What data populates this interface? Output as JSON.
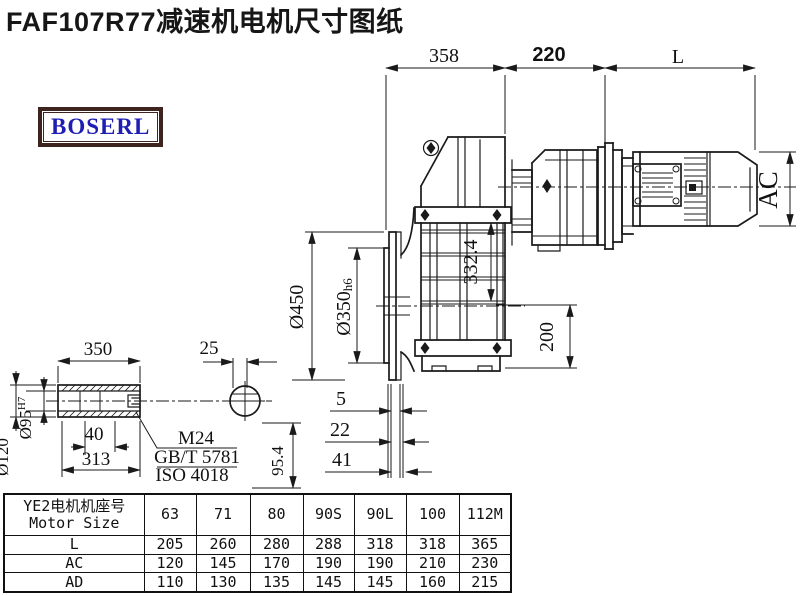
{
  "title": "FAF107R77减速机电机尺寸图纸",
  "logo": {
    "text": "BOSERL"
  },
  "drawing": {
    "dims": {
      "top_left": "358",
      "top_mid": "220",
      "top_right": "L",
      "flange_od": "Ø450",
      "spigot_main": "Ø350",
      "spigot_suffix": "h6",
      "center_height": "332.4",
      "bottom_height": "200",
      "stack_1": "5",
      "stack_2": "22",
      "stack_3": "41",
      "shaft_length": "350",
      "key_width": "25",
      "shaft_od": "Ø120",
      "bore_main": "Ø95",
      "bore_tol": "H7",
      "d40": "40",
      "d313": "313",
      "d954": "95.4",
      "thread": "M24",
      "std1": "GB/T 5781",
      "std2": "ISO 4018",
      "motor_width": "AC"
    }
  },
  "table": {
    "header_cn": "YE2电机机座号",
    "header_en": "Motor Size",
    "columns": [
      "63",
      "71",
      "80",
      "90S",
      "90L",
      "100",
      "112M"
    ],
    "rows": [
      {
        "label": "L",
        "values": [
          "205",
          "260",
          "280",
          "288",
          "318",
          "318",
          "365"
        ]
      },
      {
        "label": "AC",
        "values": [
          "120",
          "145",
          "170",
          "190",
          "190",
          "210",
          "230"
        ]
      },
      {
        "label": "AD",
        "values": [
          "110",
          "130",
          "135",
          "145",
          "145",
          "160",
          "215"
        ]
      }
    ]
  }
}
